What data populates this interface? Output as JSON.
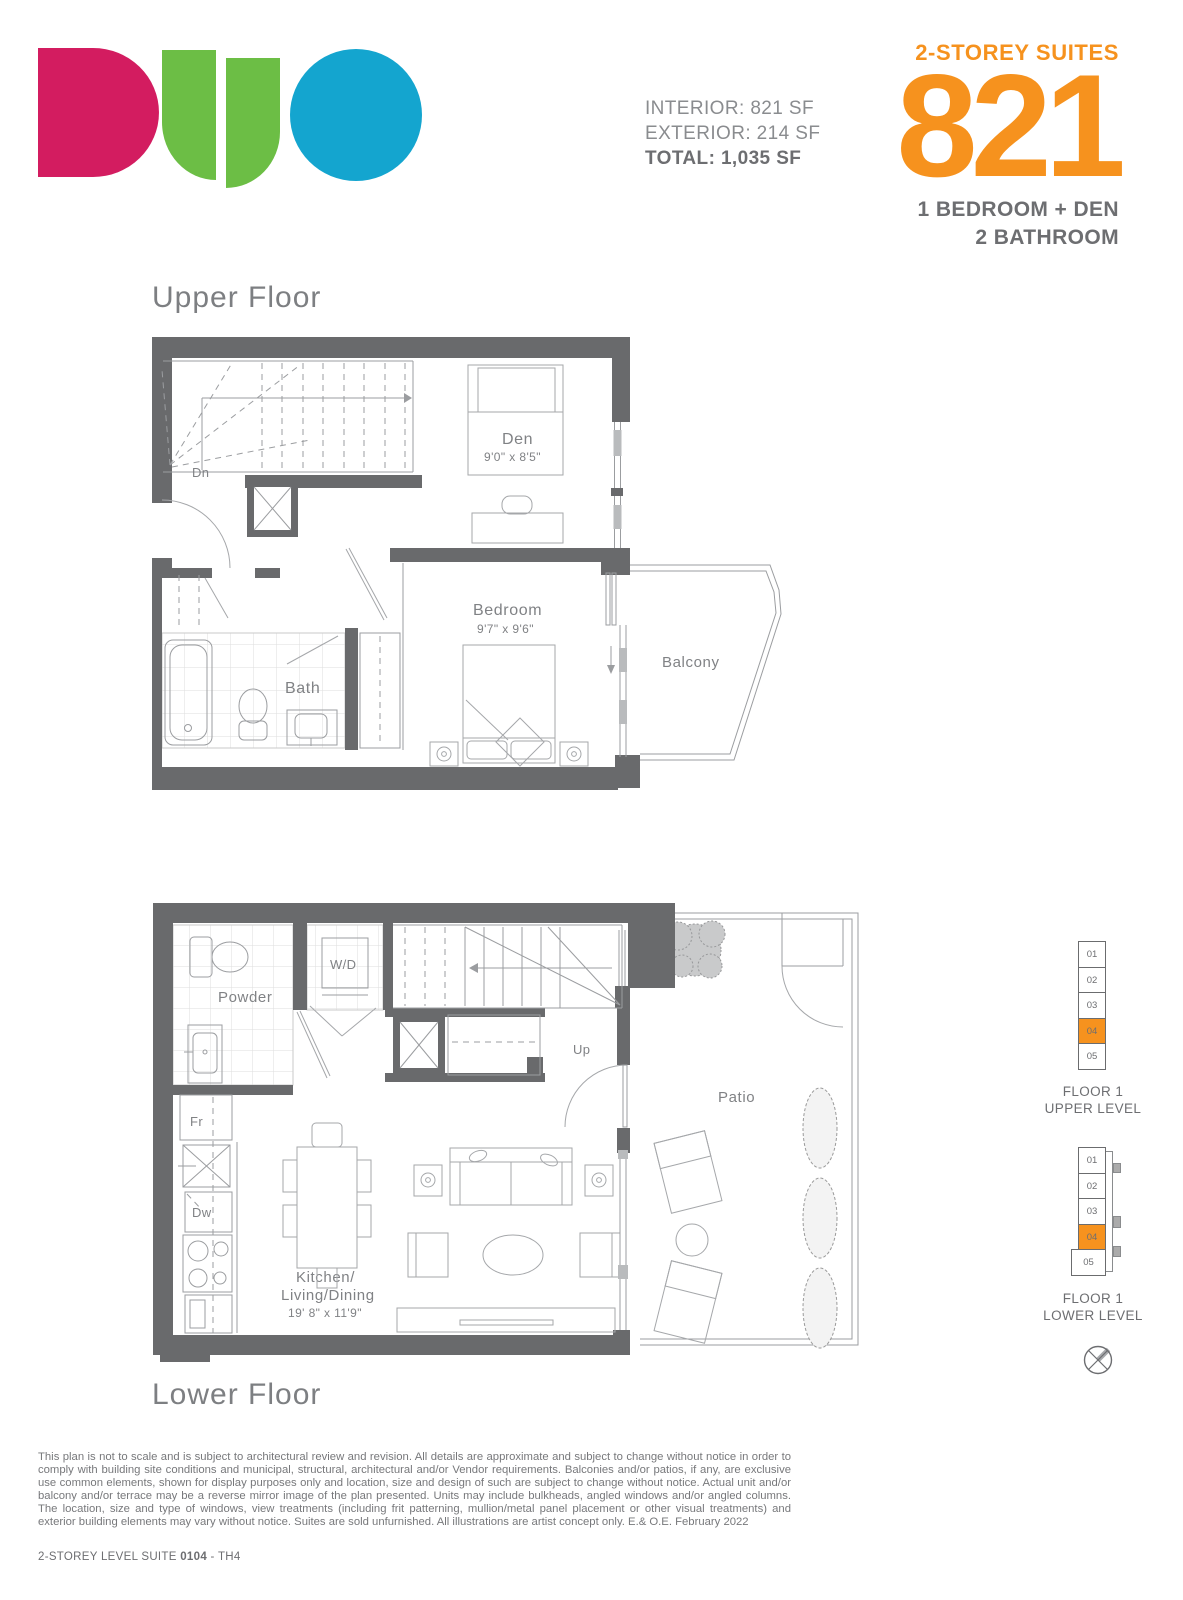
{
  "brand": {
    "name": "DUO"
  },
  "header": {
    "stats": {
      "interior": "INTERIOR: 821 SF",
      "exterior": "EXTERIOR: 214 SF",
      "total": "TOTAL: 1,035 SF"
    },
    "collection": "2-STOREY SUITES",
    "suite_number": "821",
    "config_line1": "1 BEDROOM + DEN",
    "config_line2": "2 BATHROOM"
  },
  "upper_floor": {
    "title": "Upper Floor",
    "labels": {
      "dn": "Dn",
      "den_name": "Den",
      "den_dims": "9'0\" x 8'5\"",
      "bedroom_name": "Bedroom",
      "bedroom_dims": "9'7\" x 9'6\"",
      "bath": "Bath",
      "balcony": "Balcony"
    }
  },
  "lower_floor": {
    "title": "Lower Floor",
    "labels": {
      "powder": "Powder",
      "washer_dryer": "W/D",
      "up": "Up",
      "fridge": "Fr",
      "dishwasher": "Dw",
      "kitchen_line1": "Kitchen/",
      "kitchen_line2": "Living/Dining",
      "kitchen_dims": "19' 8\" x 11'9\"",
      "patio": "Patio"
    }
  },
  "keyplans": {
    "upper": {
      "units": [
        "01",
        "02",
        "03",
        "04",
        "05"
      ],
      "highlighted_unit": "04",
      "caption_line1": "FLOOR 1",
      "caption_line2": "UPPER LEVEL"
    },
    "lower": {
      "units": [
        "01",
        "02",
        "03",
        "04",
        "05"
      ],
      "highlighted_unit": "04",
      "caption_line1": "FLOOR 1",
      "caption_line2": "LOWER LEVEL"
    }
  },
  "footer": {
    "disclaimer": "This plan is not to scale and is subject to architectural review and revision. All details are approximate and subject to change without notice in order to comply with building site conditions and municipal, structural, architectural and/or Vendor requirements. Balconies and/or patios, if any, are exclusive use common elements, shown for display purposes only and location, size and design of such are subject to change without notice. Actual unit and/or balcony and/or terrace may be a reverse mirror image of the plan presented. Units may include bulkheads, angled windows and/or angled columns. The location, size and type of windows, view treatments (including frit patterning, mullion/metal panel placement or other visual treatments) and exterior building elements may vary without notice. Suites are sold unfurnished. All illustrations are artist concept only. E.& O.E. February 2022",
    "plan_label_prefix": "2-STOREY LEVEL  SUITE ",
    "suite_code": "0104",
    "plan_label_suffix": " - TH4"
  },
  "colors": {
    "accent_orange": "#F6921E",
    "brand_pink": "#D31C60",
    "brand_green": "#6CBE45",
    "brand_blue": "#14A5CF",
    "wall_gray": "#696A6C",
    "text_gray": "#808285"
  }
}
